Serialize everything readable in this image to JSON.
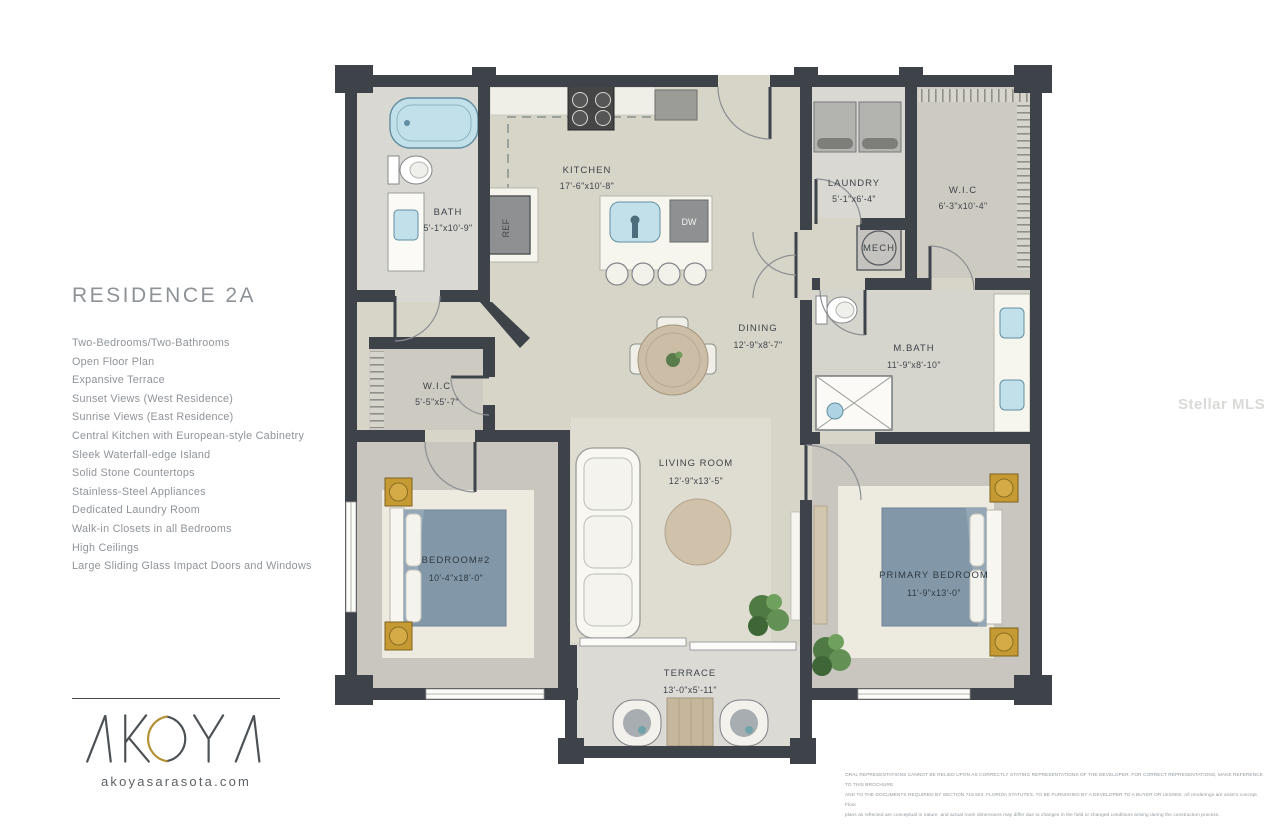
{
  "left_panel": {
    "title": "RESIDENCE 2A",
    "features": [
      "Two-Bedrooms/Two-Bathrooms",
      "Open Floor Plan",
      "Expansive Terrace",
      "Sunset Views (West Residence)",
      "Sunrise Views (East Residence)",
      "Central Kitchen with European-style Cabinetry",
      "Sleek Waterfall-edge Island",
      "Solid Stone Countertops",
      "Stainless-Steel Appliances",
      "Dedicated Laundry Room",
      "Walk-in Closets in all Bedrooms",
      "High Ceilings",
      "Large Sliding Glass Impact Doors and Windows"
    ]
  },
  "brand": {
    "logo_text": "AKOYA",
    "website": "akoyasarasota.com",
    "gold": "#b39133",
    "dark": "#4c5155"
  },
  "watermark": {
    "text": "Stellar MLS"
  },
  "floor_plan": {
    "rooms": [
      {
        "id": "bath",
        "name": "BATH",
        "dims": "5'-1\"x10'-9\""
      },
      {
        "id": "kitchen",
        "name": "KITCHEN",
        "dims": "17'-6\"x10'-8\""
      },
      {
        "id": "laundry",
        "name": "LAUNDRY",
        "dims": "5'-1\"x6'-4\""
      },
      {
        "id": "wic_right",
        "name": "W.I.C",
        "dims": "6'-3\"x10'-4\""
      },
      {
        "id": "mech",
        "name": "MECH",
        "dims": ""
      },
      {
        "id": "mbath",
        "name": "M.BATH",
        "dims": "11'-9\"x8'-10\""
      },
      {
        "id": "dining",
        "name": "DINING",
        "dims": "12'-9\"x8'-7\""
      },
      {
        "id": "wic_left",
        "name": "W.I.C",
        "dims": "5'-5\"x5'-7\""
      },
      {
        "id": "living",
        "name": "LIVING ROOM",
        "dims": "12'-9\"x13'-5\""
      },
      {
        "id": "bedroom2",
        "name": "BEDROOM#2",
        "dims": "10'-4\"x18'-0\""
      },
      {
        "id": "primary",
        "name": "PRIMARY BEDROOM",
        "dims": "11'-9\"x13'-0\""
      },
      {
        "id": "terrace",
        "name": "TERRACE",
        "dims": "13'-0\"x5'-11\""
      }
    ],
    "appliance_labels": {
      "ref": "REF",
      "dw": "DW"
    },
    "colors": {
      "wall": "#3e434a",
      "floor_main": "#d7d5c8",
      "floor_bedroom": "#c8c6be",
      "floor_closet": "#cdcbc1",
      "rug": "#edebe0",
      "bed": "#8298a8",
      "fixture_blue": "#c2e0ea",
      "gold_accent": "#c59a33",
      "plant_green": "#4f7a43",
      "terrace_floor": "#dcdad5"
    }
  },
  "disclaimer": {
    "lines": [
      "ORAL REPRESENTATIONS CANNOT BE RELIED UPON AS CORRECTLY STATING REPRESENTATIONS OF THE DEVELOPER. FOR CORRECT REPRESENTATIONS, MAKE REFERENCE TO THIS BROCHURE",
      "AND TO THE DOCUMENTS REQUIRED BY SECTION 718.503, FLORIDA STATUTES, TO BE FURNISHED BY A DEVELOPER TO A BUYER OR LESSEE. All renderings are artist's concept. Floor",
      "plans as reflected are conceptual in nature, and actual room dimensions may differ due to changes in the field or changed conditions arising during the construction process."
    ]
  }
}
